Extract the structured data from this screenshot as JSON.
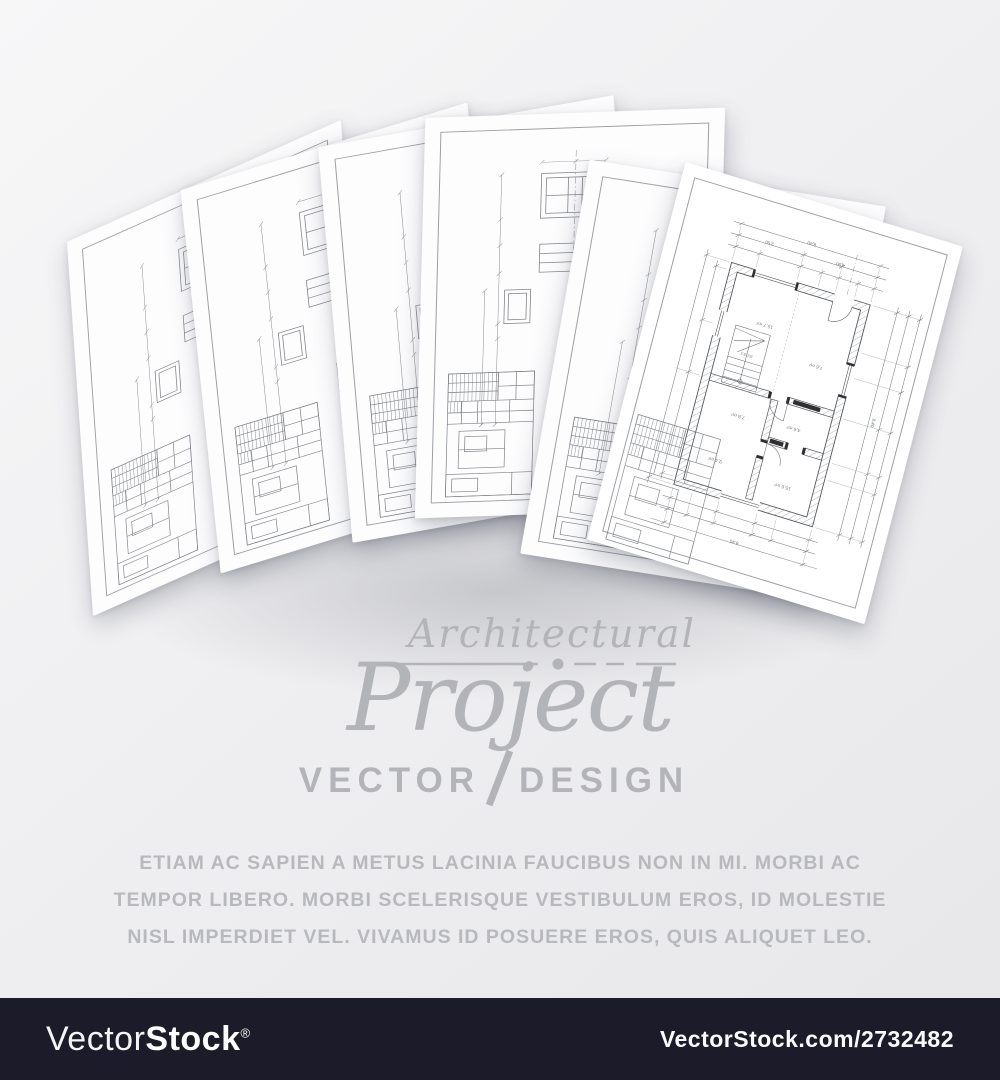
{
  "logo": {
    "script_line": "Architectural",
    "main_line": "Project",
    "sub_left": "VECTOR",
    "sub_right": "DESIGN",
    "color": "#b2b4b8"
  },
  "body_text": {
    "line1": "ETIAM AC SAPIEN A METUS LACINIA FAUCIBUS NON IN MI. MORBI AC",
    "line2": "TEMPOR LIBERO. MORBI SCELERISQUE VESTIBULUM EROS, ID MOLESTIE",
    "line3": "NISL IMPERDIET VEL. VIVAMUS ID POSUERE EROS, QUIS ALIQUET LEO.",
    "color": "#b7b9bc"
  },
  "footer": {
    "brand_regular": "Vector",
    "brand_bold": "Stock",
    "registered_mark": "®",
    "url_text": "VectorStock.com/2732482",
    "background_color": "#1b1b29",
    "text_color": "#ffffff"
  },
  "blueprints": {
    "sheet_count": 6,
    "plan_room_labels": [
      "15,7 m²",
      "7,6 m²",
      "7,8 m²",
      "4,6 m²",
      "9,4 m²",
      "15,6 m²"
    ],
    "plan_stair_label": "20/18,5",
    "plan_dimensions": {
      "top": "8,40",
      "top_left": "3,50",
      "top_right": "4,90",
      "right": "8,40",
      "bottom": "8,40"
    }
  }
}
